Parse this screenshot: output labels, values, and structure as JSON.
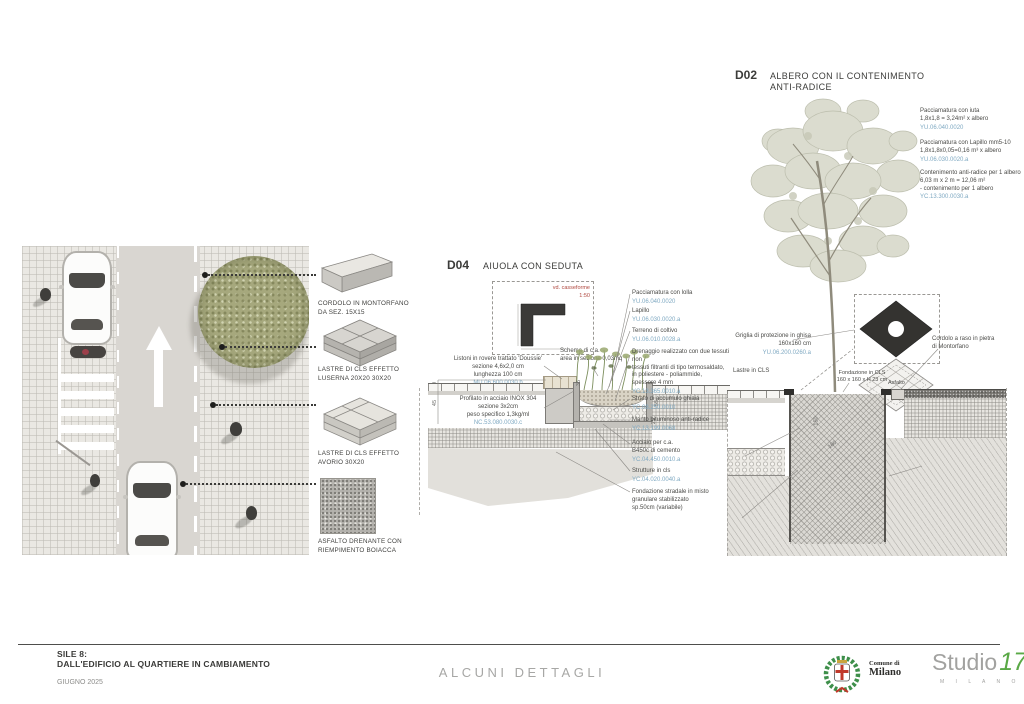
{
  "colors": {
    "code_blue": "#7fa9c2",
    "note_red": "#b0483f",
    "laurel_green": "#3e8f4a",
    "cross_red": "#c0392b",
    "studio_green": "#5aa946"
  },
  "legend": {
    "items": [
      {
        "label": "CORDOLO IN MONTORFANO\nDA SEZ. 15X15"
      },
      {
        "label": "LASTRE DI CLS EFFETTO\nLUSERNA 20X20 30X20"
      },
      {
        "label": "LASTRE DI CLS EFFETTO\nAVORIO 30X20"
      },
      {
        "label": "ASFALTO DRENANTE CON\nRIEMPIMENTO BOIACCA"
      }
    ]
  },
  "d04": {
    "code": "D04",
    "title": "AIUOLA CON SEDUTA",
    "inset": {
      "note": "vd. casseforme",
      "scale": "1:50"
    },
    "left_annotations": [
      {
        "text": "Listoni in rovere trattato 'Doussie'\nsezione 4,6x2,0 cm\nlunghezza 100 cm",
        "code": "MU.06.600.0030.b"
      },
      {
        "text": "Profilato in acciaio INOX 304\nsezione 3x2cm\npeso specifico 1,3kg/ml",
        "code": "NC.53.080.0030.c"
      }
    ],
    "schema_note": "Schema di c.a.\narea in sezione 0,03mq",
    "right_annotations": [
      {
        "text": "Pacciamatura con lolla",
        "code": "YU.06.040.0020"
      },
      {
        "text": "Lapillo",
        "code": "YU.06.030.0020.a"
      },
      {
        "text": "Terreno di coltivo",
        "code": "YU.06.010.0028.a"
      },
      {
        "text": "Drenaggio realizzato con due tessuti non\ntessuti filtranti di tipo termosaldato,\nin poliestere - poliammide,\nspessore 4 mm",
        "code": "YC.13.365.0010.a"
      },
      {
        "text": "Strato di accumulo ghiaia",
        "code": "YC.08.250.0010"
      },
      {
        "text": "Manto bituminoso anti-radice",
        "code": "YC.13.199.0068"
      },
      {
        "text": "Acciaio per c.a.\nB450c di cemento",
        "code": "YC.04.450.0010.a"
      },
      {
        "text": "Strutture in cls",
        "code": "YC.04.020.0040.a"
      },
      {
        "text": "Fondazione stradale in misto\ngranulare stabilizzato\nsp.50cm (variabile)",
        "code": ""
      }
    ],
    "dims": [
      "30",
      "45",
      "35",
      "55",
      "25"
    ]
  },
  "d02": {
    "code": "D02",
    "title": "ALBERO CON IL CONTENIMENTO\nANTI-RADICE",
    "top_annotations": [
      {
        "text": "Pacciamatura con iuta\n1,8x1,8 = 3,24m² x albero",
        "code": "YU.06.040.0020"
      },
      {
        "text": "Pacciamatura con Lapillo mm5-10\n1,8x1,8x0,05=0,16 m³ x albero",
        "code": "YU.06.030.0020.a"
      },
      {
        "text": "Contenimento anti-radice per 1 albero\n6,03 m x 2 m = 12,06 m²\n- contenimento per 1 albero",
        "code": "YC.13.300.0030.a"
      }
    ],
    "labels": {
      "griglia": {
        "text": "Griglia di protezione in ghisa\n160x160 cm",
        "code": "YU.06.200.0260.a"
      },
      "lastre": "Lastre in CLS",
      "fondazione": "Fondazione in CLS\n160 x 160 x H 23 cm",
      "asfalto": "Asfalto",
      "cordolo": "Cordolo a raso in pietra\ndi Montorfano",
      "manto": {
        "text": "Manto in polietilene estruso\nad alta densità\n(contenimento anti - radici)",
        "code": "YC.12.300.0030.a"
      },
      "riv": {
        "text": "Riv.\nterr.",
        "code": "J.06.010.0043"
      },
      "mt": "mt"
    },
    "dims": [
      "150",
      "180"
    ]
  },
  "footer": {
    "sheet_code": "SILE 8:",
    "sheet_title": "DALL'EDIFICIO AL QUARTIERE IN CAMBIAMENTO",
    "date": "GIUGNO 2025",
    "center_title": "ALCUNI DETTAGLI",
    "comune_line1": "Comune di",
    "comune_line2": "Milano",
    "studio_name": "Studio",
    "studio_number": "17",
    "studio_city": "M I L A N O"
  }
}
